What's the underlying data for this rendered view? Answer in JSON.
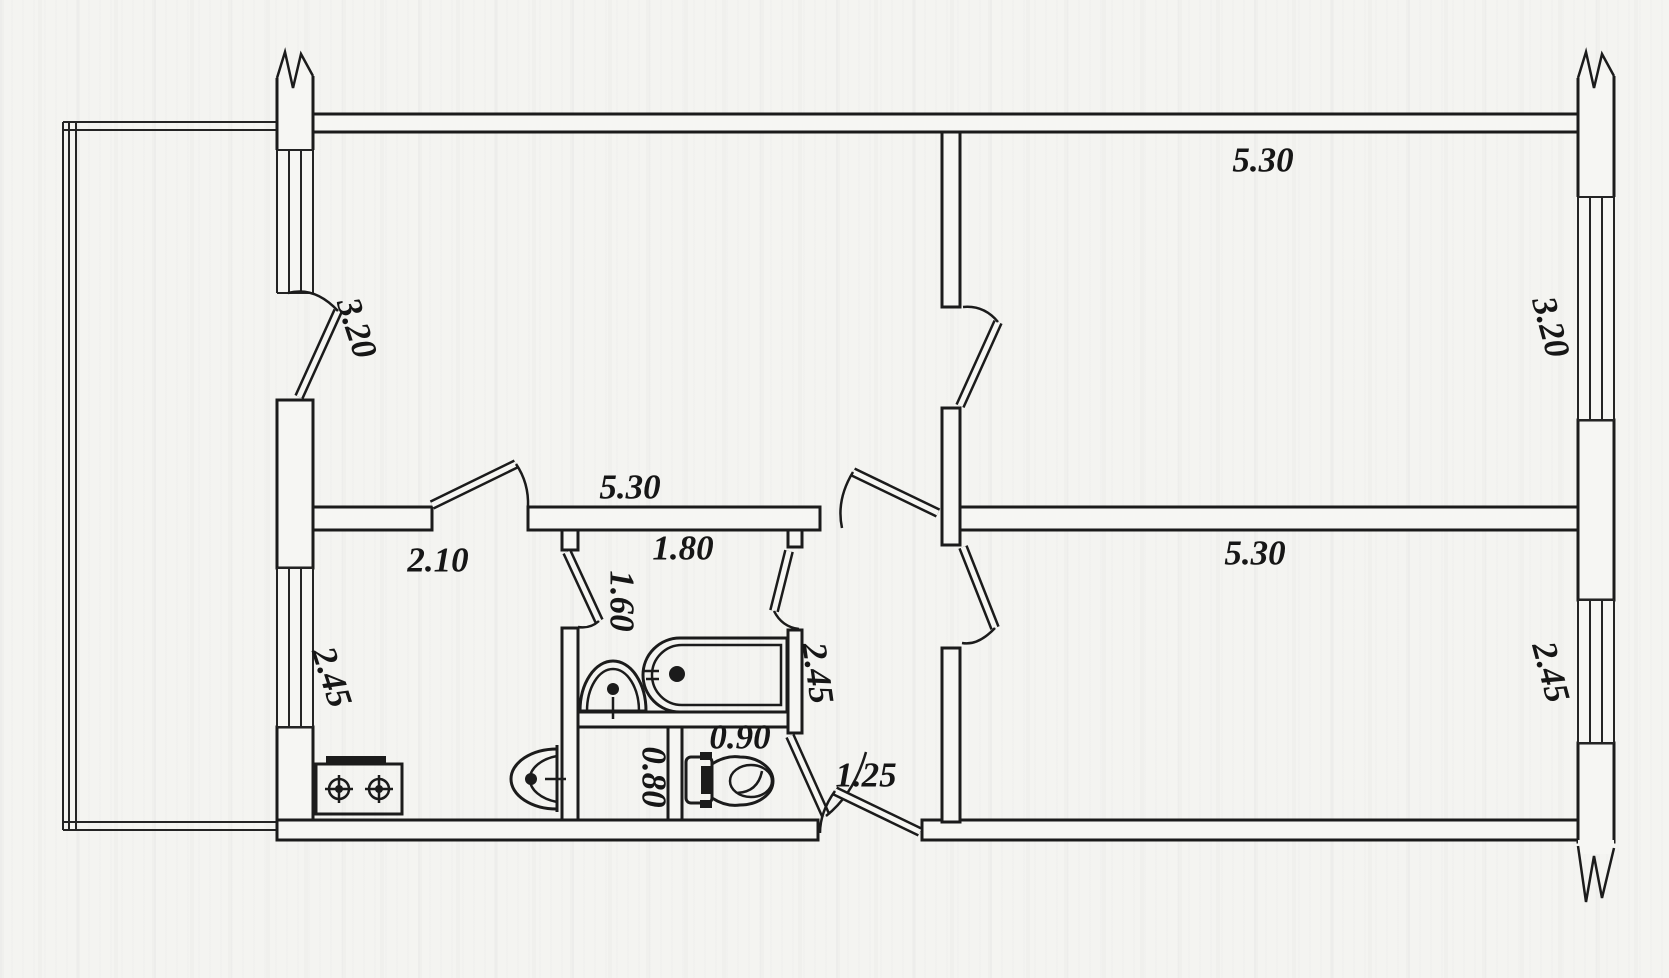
{
  "document": {
    "kind": "apartment-floor-plan-scan",
    "units": "meters"
  },
  "colors": {
    "paper": "#f4f4f1",
    "ink": "#1b1b1b"
  },
  "fixtures": [
    "bathtub",
    "wash-basin",
    "kitchen-sink",
    "gas-stove",
    "toilet"
  ],
  "labels": [
    {
      "id": "room-top-right-width",
      "text": "5.30"
    },
    {
      "id": "balcony-door-dim",
      "text": "3.20"
    },
    {
      "id": "room-top-left-width",
      "text": "5.30"
    },
    {
      "id": "kitchen-width",
      "text": "2.10"
    },
    {
      "id": "bathroom-width",
      "text": "1.80"
    },
    {
      "id": "bathroom-depth",
      "text": "1.60"
    },
    {
      "id": "bath-block-depth",
      "text": "2.45"
    },
    {
      "id": "wc-width",
      "text": "0.90"
    },
    {
      "id": "closet-width",
      "text": "0.80"
    },
    {
      "id": "entry-hall-width",
      "text": "1.25"
    },
    {
      "id": "room-top-right-depth",
      "text": "3.20"
    },
    {
      "id": "room-bottom-right-width",
      "text": "5.30"
    },
    {
      "id": "room-bottom-right-depth",
      "text": "2.45"
    },
    {
      "id": "kitchen-depth",
      "text": "2.45"
    }
  ]
}
